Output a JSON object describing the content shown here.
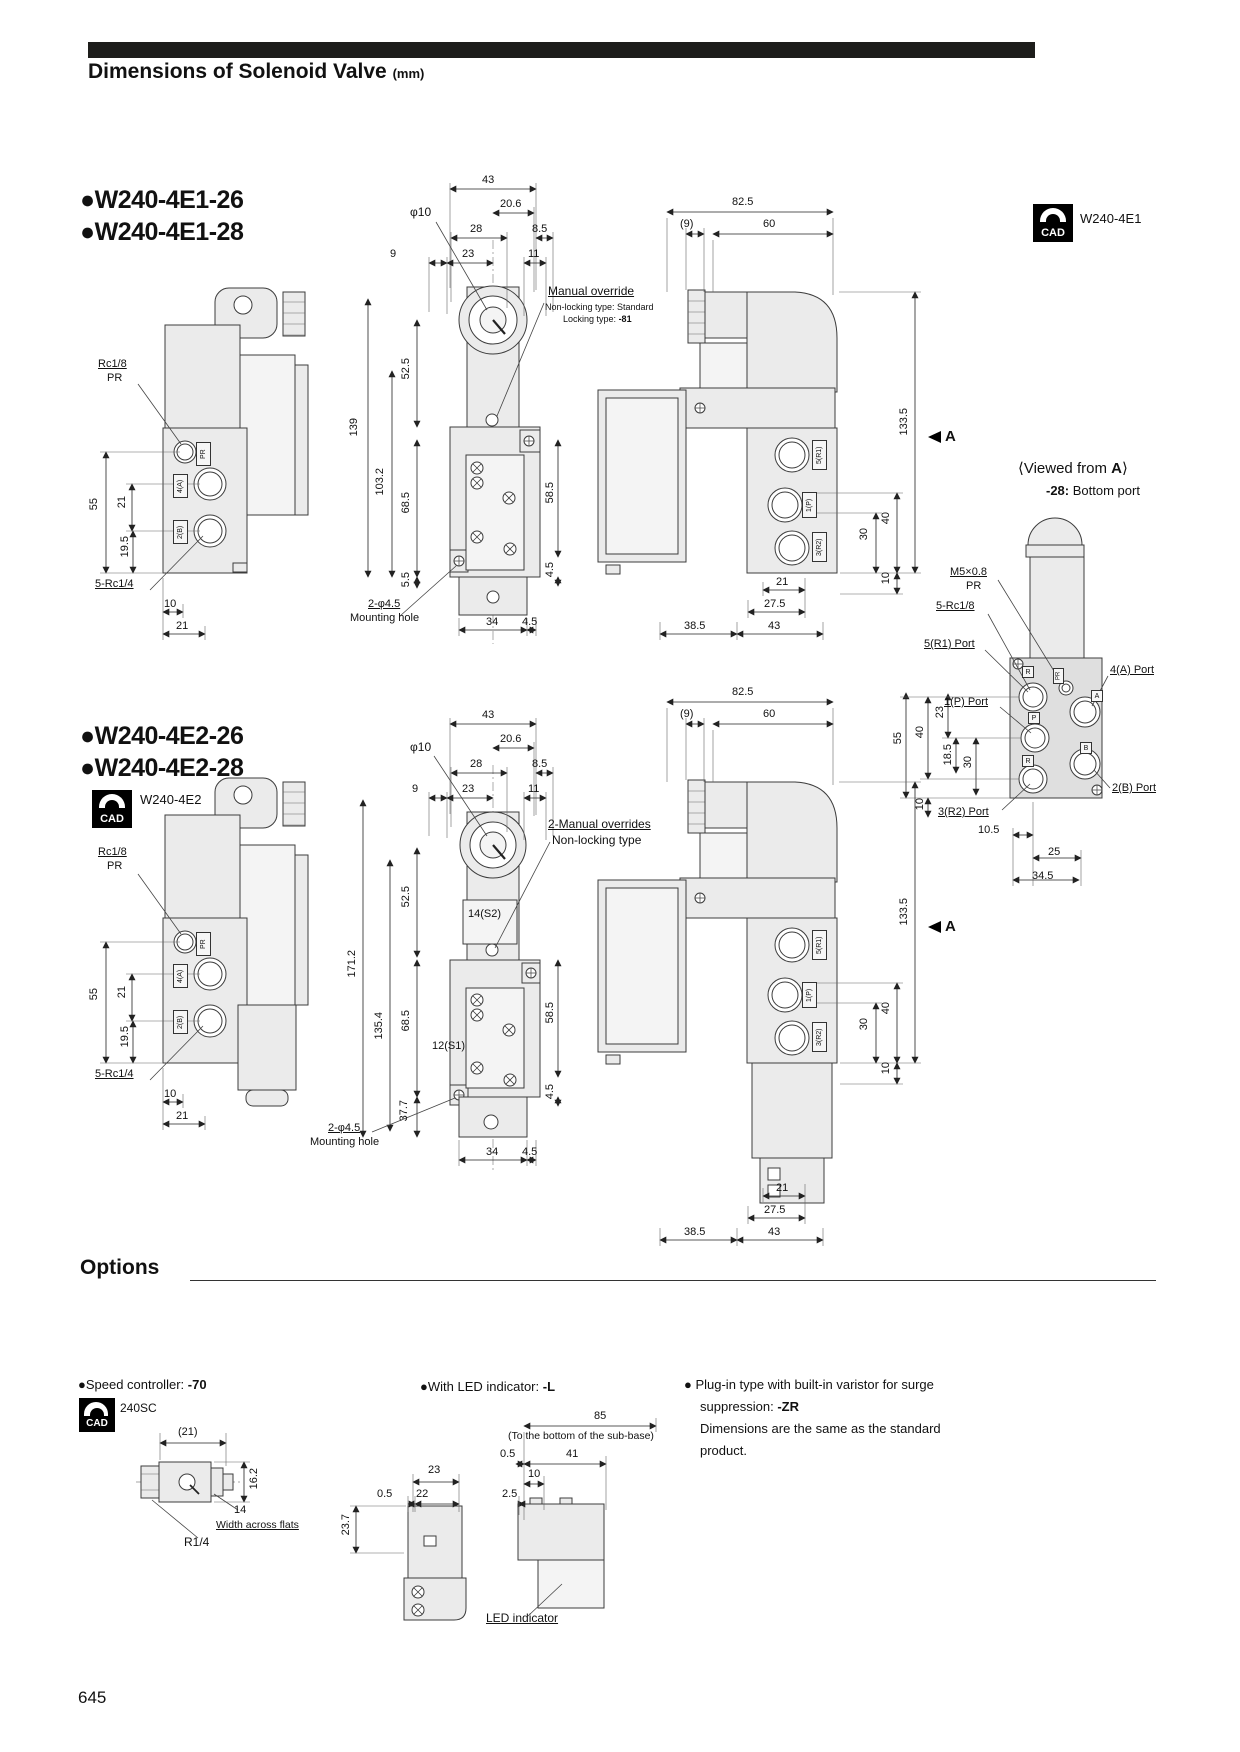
{
  "title": {
    "text": "Dimensions of Solenoid Valve",
    "unit": "(mm)"
  },
  "cad": "CAD",
  "page": "645",
  "opt_heading": "Options",
  "s1": {
    "m1": "●W240-4E1-26",
    "m2": "●W240-4E1-28",
    "cadm": "W240-4E1",
    "lv": {
      "rc18": "Rc1/8",
      "pr": "PR",
      "d55": "55",
      "d21": "21",
      "d195": "19.5",
      "rc14": "5-Rc1/4",
      "d10": "10",
      "d21b": "21",
      "tpr": "PR",
      "ta": "4(A)",
      "tb": "2(B)"
    },
    "fv": {
      "d43": "43",
      "d206": "20.6",
      "phi": "φ10",
      "d28": "28",
      "d85": "8.5",
      "d9": "9",
      "d23": "23",
      "d11": "11",
      "mo1": "Manual override",
      "mo2": "Non-locking type: Standard",
      "mo3": "Locking type:",
      "mo3b": "-81",
      "v525": "52.5",
      "v139": "139",
      "v1032": "103.2",
      "v685": "68.5",
      "v585": "58.5",
      "v55": "5.5",
      "v45": "4.5",
      "b34": "34",
      "b45": "4.5",
      "mh1": "2-φ4.5",
      "mh2": "Mounting hole"
    },
    "sv": {
      "d825": "82.5",
      "d9p": "(9)",
      "d60": "60",
      "v1335": "133.5",
      "a": "A",
      "v40": "40",
      "v30": "30",
      "v10": "10",
      "b21": "21",
      "b275": "27.5",
      "b385": "38.5",
      "b43": "43",
      "t1": "5(R1)",
      "t2": "1(P)",
      "t3": "3(R2)"
    },
    "va": {
      "tp": "⟨Viewed from ",
      "ta": "A",
      "tc": "⟩",
      "sb": "-28:",
      "st": " Bottom port",
      "l1": "M5×0.8",
      "l2": "PR",
      "l3": "5-Rc1/8",
      "l4": "5(R1) Port",
      "l5": "1(P) Port",
      "l6": "3(R2) Port",
      "l7": "4(A) Port",
      "l8": "2(B) Port",
      "d55": "55",
      "d40": "40",
      "d23": "23",
      "d185": "18.5",
      "d30": "30",
      "d10": "10",
      "d105": "10.5",
      "d25": "25",
      "d345": "34.5",
      "g1": "R",
      "g2": "PR",
      "g3": "A",
      "g4": "P",
      "g5": "R",
      "g6": "B"
    }
  },
  "s2": {
    "m1": "●W240-4E2-26",
    "m2": "●W240-4E2-28",
    "cadm": "W240-4E2",
    "lv": {
      "rc18": "Rc1/8",
      "pr": "PR",
      "d55": "55",
      "d21": "21",
      "d195": "19.5",
      "rc14": "5-Rc1/4",
      "d10": "10",
      "d21b": "21",
      "tpr": "PR",
      "ta": "4(A)",
      "tb": "2(B)"
    },
    "fv": {
      "d43": "43",
      "d206": "20.6",
      "phi": "φ10",
      "d28": "28",
      "d85": "8.5",
      "d9": "9",
      "d23": "23",
      "d11": "11",
      "mo1": "2-Manual overrides",
      "mo2": "Non-locking type",
      "s14": "14(S2)",
      "s12": "12(S1)",
      "v525": "52.5",
      "v1712": "171.2",
      "v1354": "135.4",
      "v685": "68.5",
      "v377": "37.7",
      "v585": "58.5",
      "v45": "4.5",
      "b34": "34",
      "b45": "4.5",
      "mh1": "2-φ4.5",
      "mh2": "Mounting hole"
    },
    "sv": {
      "d825": "82.5",
      "d9p": "(9)",
      "d60": "60",
      "v1335": "133.5",
      "a": "A",
      "v40": "40",
      "v30": "30",
      "v10": "10",
      "b21": "21",
      "b275": "27.5",
      "b385": "38.5",
      "b43": "43",
      "t1": "5(R1)",
      "t2": "1(P)",
      "t3": "3(R2)"
    }
  },
  "opt": {
    "sc": {
      "label": "●Speed controller:",
      "code": "-70",
      "model": "240SC",
      "d21": "(21)",
      "d162": "16.2",
      "d14": "14",
      "waf": "Width across flats",
      "r14": "R1/4"
    },
    "led": {
      "label": "●With LED indicator:",
      "code": "-L",
      "d85": "85",
      "note": "(To the bottom of the sub-base)",
      "d05a": "0.5",
      "d41": "41",
      "d10": "10",
      "d25": "2.5",
      "d23": "23",
      "d05b": "0.5",
      "d22": "22",
      "d237": "23.7",
      "callout": "LED indicator"
    },
    "zr": {
      "l1": "● Plug-in type with built-in varistor for surge",
      "l2": "suppression:",
      "code": "-ZR",
      "l3": "Dimensions are the same as the standard",
      "l4": "product."
    }
  }
}
